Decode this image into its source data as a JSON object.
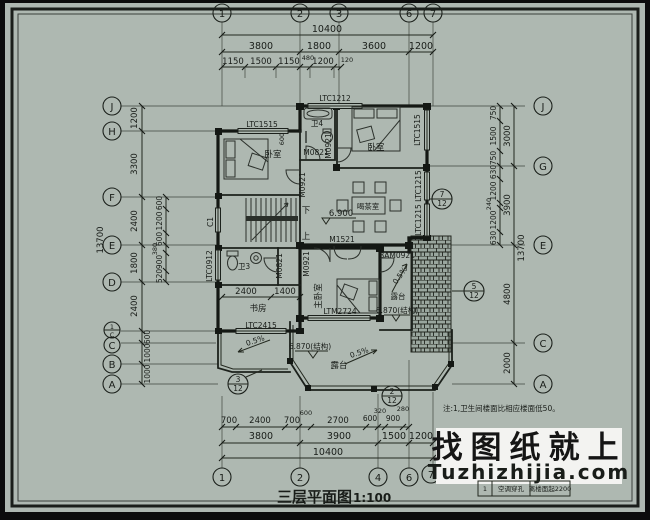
{
  "paper_color": "#aeb8b1",
  "line_color": "#23281f",
  "grid": {
    "top": [
      "1",
      "2",
      "3",
      "6",
      "7"
    ],
    "bottom": [
      "1",
      "2",
      "4",
      "6",
      "7"
    ],
    "left": [
      "J",
      "H",
      "F",
      "E",
      "D",
      "C",
      "B",
      "A"
    ],
    "left_sub": {
      "num": "1",
      "den": "C"
    },
    "right": [
      "J",
      "G",
      "E",
      "C",
      "A"
    ]
  },
  "dims": {
    "top": {
      "overall": "10400",
      "segments": [
        "3800",
        "1800",
        "3600",
        "1200"
      ],
      "sub": [
        "1150",
        "1500",
        "1150",
        "480",
        "1200",
        "120"
      ]
    },
    "bottom": {
      "overall": "10400",
      "segments": [
        "3800",
        "3900",
        "1500",
        "1200"
      ],
      "sub": [
        "700",
        "2400",
        "700",
        "600",
        "2700",
        "600",
        "320",
        "900",
        "280"
      ]
    },
    "left": {
      "overall": "13700",
      "segments": [
        "1200",
        "3300",
        "2400",
        "1800",
        "2400",
        "600",
        "1000",
        "1000"
      ],
      "sub": [
        "600",
        "1200",
        "600",
        "380",
        "900",
        "520"
      ]
    },
    "right": {
      "overall": "13700",
      "groups": [
        "3000",
        "3900",
        "4800",
        "2000"
      ],
      "sub": [
        "750",
        "1500",
        "750",
        "630",
        "1200",
        "240",
        "1200",
        "630"
      ]
    },
    "interior": [
      "2400",
      "1400",
      "600"
    ]
  },
  "labels": {
    "windows": {
      "ltc1212": "LTC1212",
      "ltc1515": "LTC1515",
      "ltc1515r": "LTC1515",
      "ltc1215a": "LTC1215",
      "ltc1215b": "LTC1215",
      "c1": "C1",
      "ltc0912": "LTC0912",
      "ltc2415": "LTC2415",
      "ltm2724": "LTM2724"
    },
    "doors": {
      "m0821a": "M0821",
      "m0821b": "M0821",
      "m0921a": "M0921",
      "m0921b": "M0921",
      "m0921c": "M0921",
      "m1521": "M1521",
      "bam0921": "BAM0921"
    },
    "rooms": {
      "bedroom_left": "卧室",
      "bedroom_right": "卧室",
      "bath4": "卫4",
      "bath3": "卫3",
      "study": "书房",
      "master": "主卧室",
      "tea": "喝茶室",
      "terrace_bottom": "露台",
      "terrace_right": "露台"
    },
    "stairs": {
      "up": "上",
      "down": "下"
    },
    "elevations": {
      "tea": "6.900",
      "terrace_bottom": "6.870(结构)",
      "terrace_right": "6.870(结构)"
    },
    "slopes": [
      "0.5%",
      "0.5%",
      "0.5%"
    ]
  },
  "details": [
    {
      "num": "7",
      "den": "12"
    },
    {
      "num": "5",
      "den": "12"
    },
    {
      "num": "3",
      "den": "12"
    },
    {
      "num": "2",
      "den": "12"
    }
  ],
  "note": {
    "text": "注:1,卫生间楼面比相应楼面低50。"
  },
  "title": {
    "text": "三层平面图",
    "scale": "1:100"
  },
  "watermark": {
    "line1": "找图纸就上",
    "line2": "Tuzhizhijia.com",
    "accent": "#2121c4"
  },
  "legend": {
    "cells": [
      "1",
      "空调穿孔",
      "离楼面起2200"
    ]
  }
}
